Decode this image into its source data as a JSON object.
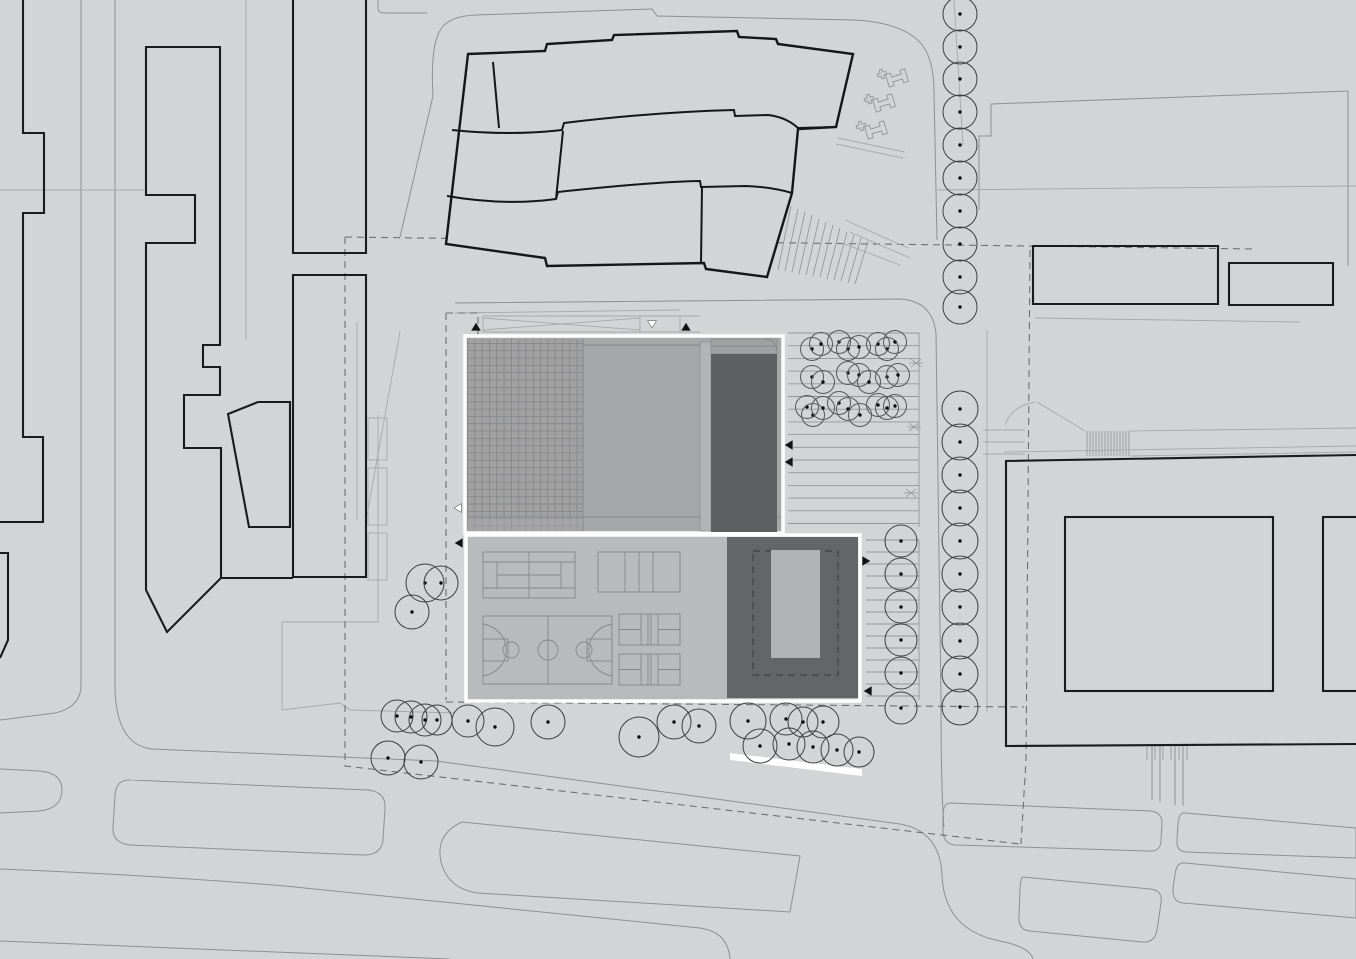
{
  "title": "architectural-site-plan",
  "palette": {
    "background": "#d3d4d5",
    "panel_border": "#ffffff",
    "upper_panel_fill": "#a6a7a8",
    "upper_dark_block": "#5e5f60",
    "upper_light_strip": "#b3b4b5",
    "grid_cell": "#a1a1a2",
    "grid_line": "#7d7f80",
    "lower_panel_fill": "#b9babb",
    "lower_dark_block": "#646567",
    "skylight_fill": "#b1b2b4",
    "white_path": "#ffffff",
    "bold_stroke": "#1b1b1b",
    "road_stroke": "#8e9092",
    "dash_stroke": "#6d6f71",
    "arrow_black": "#111111",
    "arrow_white": "#ffffff"
  },
  "parking_stripes": {
    "upper": {
      "x1": 788,
      "x2": 919,
      "y0": 333,
      "dy": 12.7,
      "count": 16
    },
    "lower": {
      "x1": 866,
      "x2": 919,
      "y0": 540,
      "dy": 12,
      "count": 14
    }
  },
  "trees": {
    "avenue": {
      "x": 960,
      "runs": [
        {
          "r": 17,
          "ys": [
            14,
            47,
            79,
            112,
            145,
            178,
            211,
            244,
            277,
            307
          ]
        },
        {
          "r": 18,
          "ys": [
            409,
            442,
            475,
            508,
            541,
            574,
            607,
            641,
            674,
            707
          ]
        }
      ]
    },
    "column": {
      "x": 901,
      "r": 16,
      "ys": [
        541,
        574,
        607,
        640,
        673
      ]
    },
    "scattered": [
      [
        397,
        716,
        16
      ],
      [
        411,
        717,
        16
      ],
      [
        425,
        720,
        16
      ],
      [
        437,
        720,
        15
      ],
      [
        468,
        721,
        16
      ],
      [
        495,
        727,
        19
      ],
      [
        548,
        722,
        17
      ],
      [
        388,
        758,
        17
      ],
      [
        421,
        762,
        17
      ],
      [
        412,
        612,
        17
      ],
      [
        425,
        583,
        19
      ],
      [
        441,
        583,
        17
      ],
      [
        639,
        737,
        20
      ],
      [
        674,
        722,
        17
      ],
      [
        699,
        726,
        17
      ],
      [
        748,
        721,
        18
      ],
      [
        786,
        719,
        16
      ],
      [
        803,
        722,
        15
      ],
      [
        823,
        722,
        16
      ],
      [
        760,
        746,
        17
      ],
      [
        789,
        744,
        16
      ],
      [
        813,
        747,
        16
      ],
      [
        837,
        750,
        16
      ],
      [
        859,
        752,
        15
      ],
      [
        901,
        708,
        16
      ]
    ],
    "parking_small_r": 11.5,
    "parking_small": [
      [
        812,
        349
      ],
      [
        821,
        344
      ],
      [
        839,
        342
      ],
      [
        848,
        349
      ],
      [
        859,
        347
      ],
      [
        878,
        344
      ],
      [
        887,
        349
      ],
      [
        895,
        342
      ],
      [
        812,
        377
      ],
      [
        823,
        382
      ],
      [
        848,
        373
      ],
      [
        859,
        375
      ],
      [
        869,
        382
      ],
      [
        887,
        377
      ],
      [
        898,
        375
      ],
      [
        807,
        407
      ],
      [
        813,
        415
      ],
      [
        823,
        408
      ],
      [
        839,
        403
      ],
      [
        848,
        409
      ],
      [
        860,
        415
      ],
      [
        878,
        405
      ],
      [
        887,
        408
      ],
      [
        895,
        406
      ]
    ]
  },
  "markers": {
    "arrows": [
      {
        "x": 476,
        "y": 327,
        "dir": "up",
        "fill": "#111111"
      },
      {
        "x": 686,
        "y": 327,
        "dir": "up",
        "fill": "#111111"
      },
      {
        "x": 652,
        "y": 324,
        "dir": "down",
        "fill": "#ffffff"
      },
      {
        "x": 789,
        "y": 445,
        "dir": "left",
        "fill": "#111111"
      },
      {
        "x": 789,
        "y": 462,
        "dir": "left",
        "fill": "#111111"
      },
      {
        "x": 458,
        "y": 508,
        "dir": "left",
        "fill": "#ffffff"
      },
      {
        "x": 459,
        "y": 543,
        "dir": "left",
        "fill": "#111111"
      },
      {
        "x": 866,
        "y": 561,
        "dir": "right",
        "fill": "#111111"
      },
      {
        "x": 868,
        "y": 691,
        "dir": "left",
        "fill": "#111111"
      }
    ],
    "x_marks": [
      [
        916,
        363
      ],
      [
        914,
        427
      ],
      [
        911,
        493
      ]
    ]
  }
}
